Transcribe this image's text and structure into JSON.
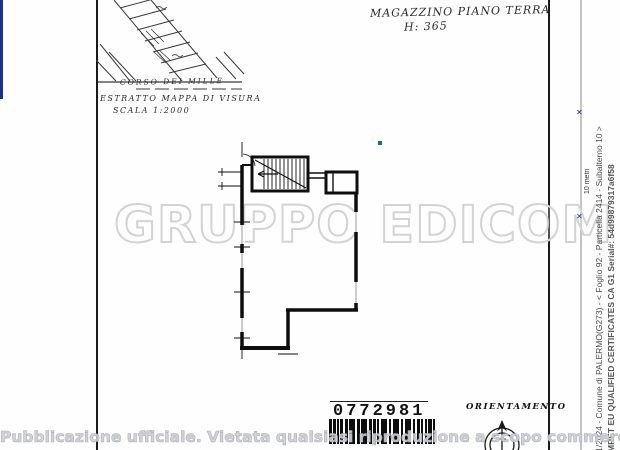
{
  "page": {
    "handwriting": {
      "title_line1": "MAGAZZINO PIANO TERRA",
      "title_line2": "H: 365"
    },
    "map_extract": {
      "street": "CORSO DEI MILLE",
      "caption1": "ESTRATTO MAPPA DI VISURA",
      "caption2": "SCALA 1:2000"
    },
    "watermark": {
      "brand": "GRUPPO EDICOM",
      "color": "#d3d3d3"
    },
    "stamp": {
      "barcode_number": "0772981"
    },
    "compass": {
      "label": "ORIENTAMENTO"
    },
    "overlay": {
      "notice": "Pubblicazione ufficiale. Vietata qualsiasi riproduzione a scopo commerciale"
    },
    "right_margin": {
      "reference_line": "1/2024 - Comune di PALERMO(G273) - < Foglio 92 - Particella 2414 - Subalterno 10 >",
      "certificate_line": "MRET EU QUALIFIED CERTIFICATES CA G1 Serial#: 54d99879317a6f58",
      "scale_bar_label": "10 metri",
      "scale_bar_color": "#22307a"
    }
  }
}
